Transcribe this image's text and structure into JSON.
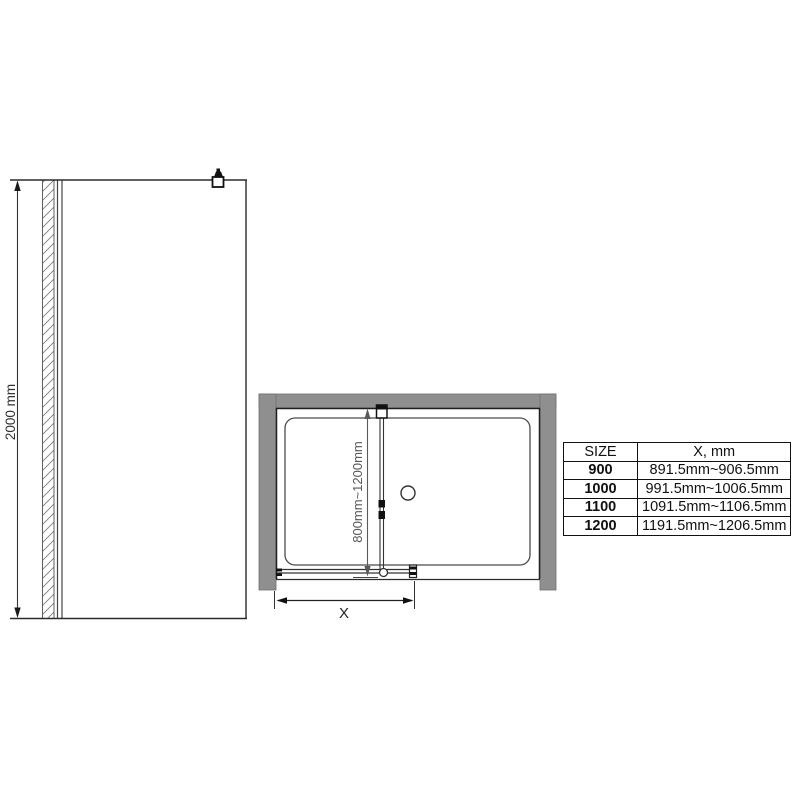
{
  "front_view": {
    "height_dimension": "2000 mm"
  },
  "plan_view": {
    "door_width_range": "800mm~1200mm",
    "opening_dimension": "X"
  },
  "size_table": {
    "headers": [
      "SIZE",
      "X, mm"
    ],
    "rows": [
      {
        "size": "900",
        "x_range": "891.5mm~906.5mm"
      },
      {
        "size": "1000",
        "x_range": "991.5mm~1006.5mm"
      },
      {
        "size": "1100",
        "x_range": "1091.5mm~1106.5mm"
      },
      {
        "size": "1200",
        "x_range": "1191.5mm~1206.5mm"
      }
    ]
  },
  "colors": {
    "wall_gray": "#8f8f8f",
    "line_dark": "#2b2b2b",
    "dimension_gray": "#595959"
  }
}
